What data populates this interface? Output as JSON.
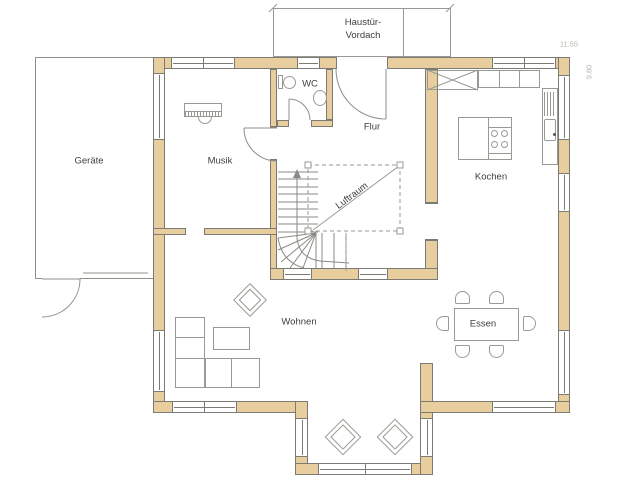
{
  "colors": {
    "wall_fill": "#e8cd9e",
    "wall_line": "#7b7b74",
    "thin_line": "#9a9a94",
    "text": "#3f3f3f",
    "dim_text": "#b7b3ab",
    "background": "#ffffff"
  },
  "rooms": {
    "geraete": "Geräte",
    "musik": "Musik",
    "wc": "WC",
    "flur": "Flur",
    "kochen": "Kochen",
    "wohnen": "Wohnen",
    "essen": "Essen",
    "luftraum": "Luftraum"
  },
  "annotations": {
    "canopy_line1": "Haustür-",
    "canopy_line2": "Vordach",
    "dim_width": "11.55",
    "dim_height": "9.80"
  }
}
